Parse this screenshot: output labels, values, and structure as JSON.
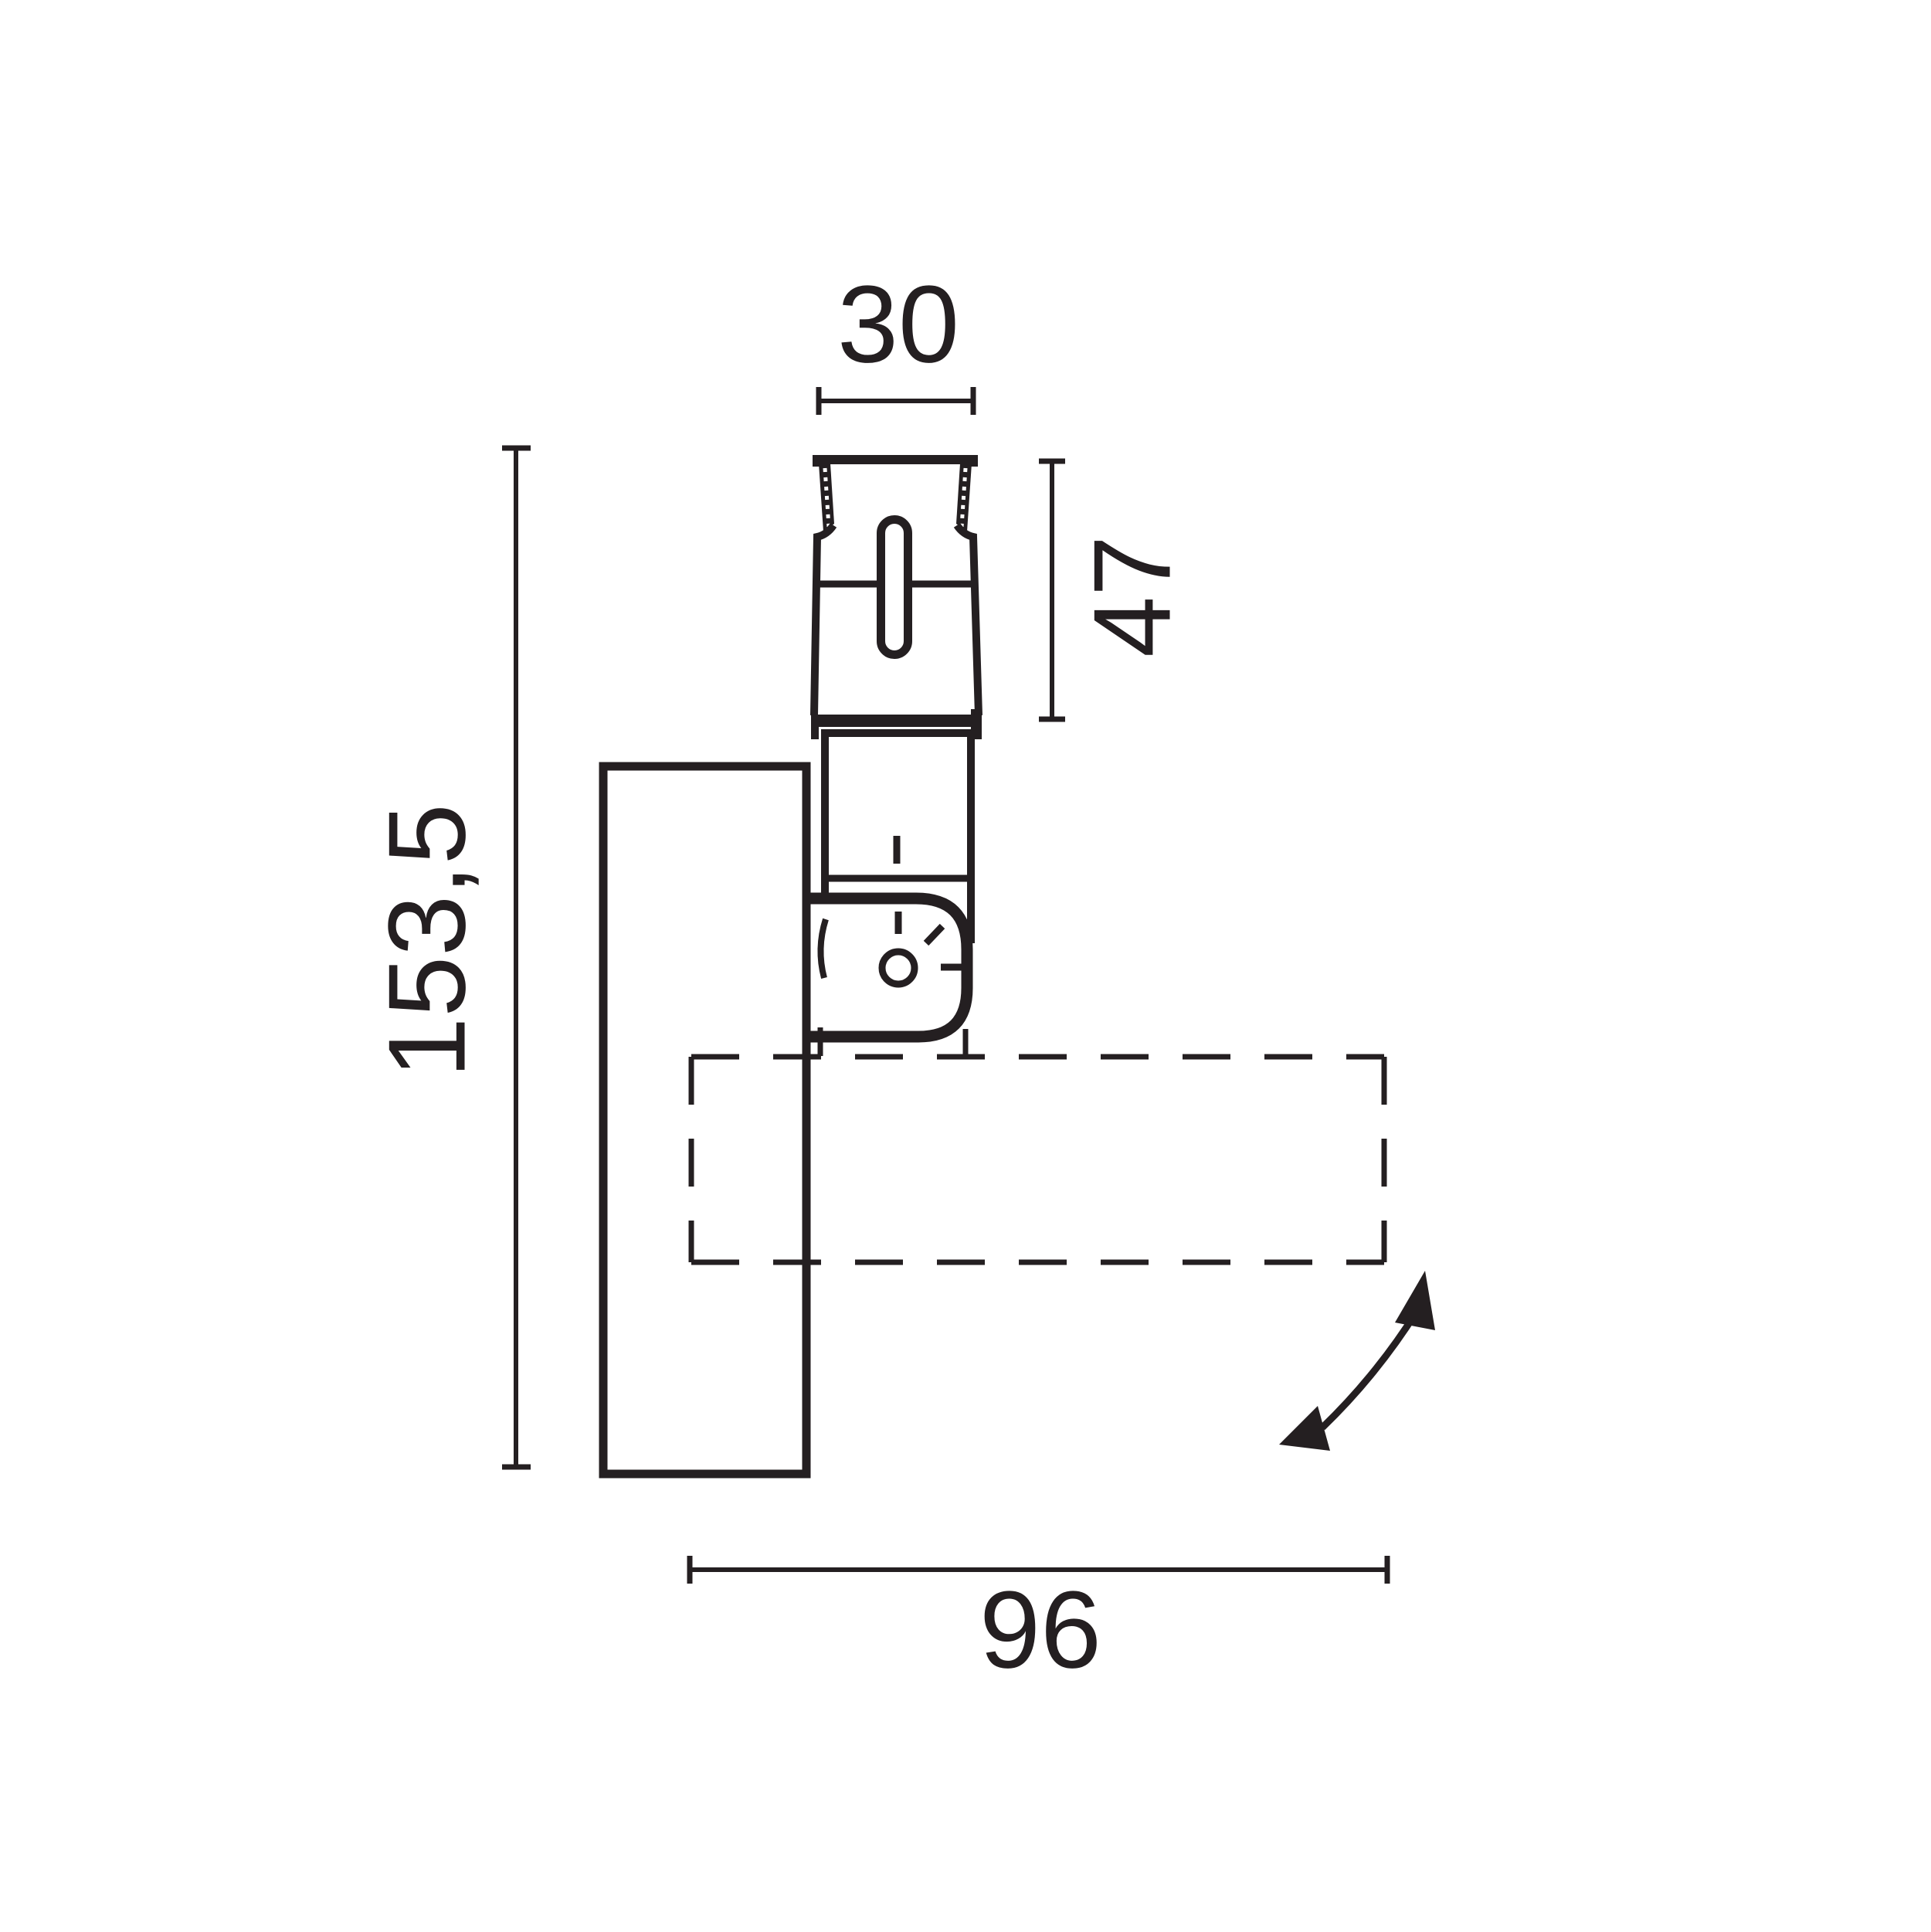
{
  "drawing": {
    "type": "technical-dimension-drawing",
    "line_color": "#241f21",
    "background_color": "#ffffff",
    "dimensions": {
      "grip_width": "30",
      "grip_height": "47",
      "overall_height": "153,5",
      "handle_projection": "96"
    }
  }
}
